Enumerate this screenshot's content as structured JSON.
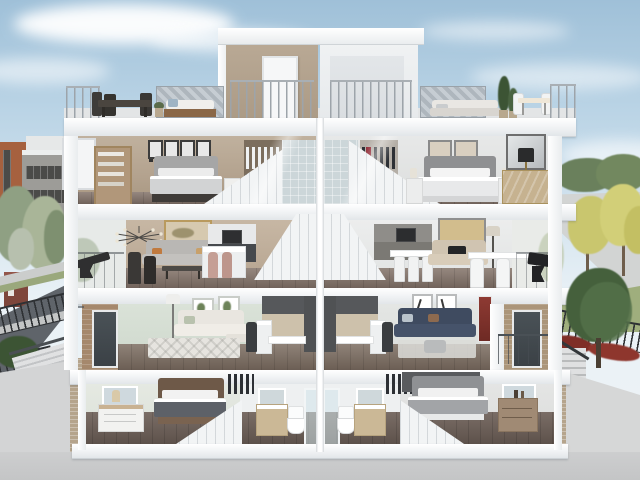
{
  "scene": {
    "kind": "3d-architectural-cutaway-render",
    "subject": "Cross-section (dollhouse) view of a pair of mirrored four-storey townhomes with rooftop terraces",
    "time_of_day": "day",
    "setting": "suburban street with landscaped boulevard"
  },
  "palette": {
    "sky_top": "#9fc0d8",
    "sky_horizon": "#eef3f6",
    "cloud": "#ffffff",
    "slab_white": "#f3f4f6",
    "cut_wall_white": "#fbfcfd",
    "wall_taupe": "#b3a28e",
    "wall_beige": "#bfae99",
    "wall_mint": "#d3dcd1",
    "wall_pale_gray": "#e2e4e3",
    "tile_blue_gray": "#ccd6d9",
    "terrace_deck": "#e3e5e6",
    "floor_wood": "#84746a",
    "floor_wood_dark": "#6b5d55",
    "kitchen_charcoal": "#46494d",
    "kitchen_greige": "#8f8d89",
    "cabinet_oak": "#cdc1ab",
    "sofa_gray": "#b9b7b4",
    "sofa_navy": "#3f4b60",
    "sofa_cream": "#e9e6e0",
    "sofa_beige": "#d0c4b1",
    "bed_duvet_charcoal": "#5d6168",
    "closet_accent_red": "#8e2430",
    "stool_blush": "#c59f95",
    "brick": "#a5886c",
    "privacy_screen": "#b9c1c7",
    "metal_railing": "#9fa6ab",
    "fence_black": "#2e3134",
    "asphalt": "#60646a",
    "sidewalk": "#c7c9c9",
    "concrete": "#d2d3d4",
    "grass": "#a3b07f",
    "tree_green": "#45603c",
    "tree_sage": "#93a383",
    "tree_yellow": "#c9c66e",
    "shrub_red": "#7f2e27"
  },
  "building": {
    "type": "two mirrored units around a central party wall, section cut facing the street",
    "floors": [
      {
        "name": "rooftop terrace",
        "left_unit": [
          "stair bulkhead with white door",
          "metal guard railing",
          "grey privacy screen",
          "dark outdoor dining set",
          "upholstered daybed",
          "planter"
        ],
        "right_unit": [
          "open stair bulkhead",
          "metal guard railing",
          "grey privacy screen",
          "cream outdoor sofa",
          "two potted evergreens",
          "bistro table with chairs"
        ]
      },
      {
        "name": "third floor bedrooms",
        "left_unit": [
          "open casement window",
          "oak bookcase",
          "four framed prints",
          "grey upholstered bed with sconces",
          "walk-in closet with white shirts and dark suits",
          "staircase",
          "tiled ensuite"
        ],
        "right_unit": [
          "tiled ensuite",
          "walk-in closet with red and dark garments",
          "staircase",
          "bed with white duvet and nightstand lamps",
          "pair of framed landscapes",
          "large framed artwork",
          "wood credenza with black table lamp"
        ]
      },
      {
        "name": "second floor living",
        "left_unit": [
          "balcony with black lounge chair",
          "sputnik chandelier",
          "framed abstract art",
          "grey sofa",
          "dark coffee table",
          "two dark dining chairs",
          "white and charcoal kitchen with microwave",
          "island with two blush stools",
          "staircase"
        ],
        "right_unit": [
          "staircase",
          "greige kitchen with microwave",
          "white table with stools",
          "beige sofa with black throw",
          "framed golden-field artwork",
          "floor lamp",
          "white desk with two chairs",
          "balcony with black butterfly chair"
        ]
      },
      {
        "name": "ground floor",
        "left_unit": [
          "brick facade with glazed door and glass balcony rail",
          "arc floor lamp",
          "botanical prints",
          "cream sectional sofa",
          "patterned rug",
          "charcoal and oak kitchen with white peninsula",
          "dark bar stool"
        ],
        "right_unit": [
          "charcoal and oak kitchen with white peninsula",
          "dark bar stool",
          "two framed figure sketches",
          "navy sectional sofa",
          "grey ottoman",
          "rug",
          "red artwork at the cut edge",
          "brick facade with glazed door and dark balcony railing"
        ]
      },
      {
        "name": "basement",
        "left_unit": [
          "egress window",
          "white nightstand with table lamp",
          "wood bed with charcoal duvet",
          "open clothes rack",
          "staircase",
          "bathroom with mirror, vanity, toilet and glass shower"
        ],
        "right_unit": [
          "bathroom with glass shower, toilet, vanity and mirror",
          "open clothes rack",
          "charcoal accent wall",
          "grey upholstered bed",
          "staircase",
          "wood dresser with decor",
          "egress window"
        ]
      }
    ]
  },
  "surroundings": {
    "left": [
      "orange-brick and grey townhouses",
      "white low-rise with roof rail",
      "street trees",
      "entry monument",
      "sidewalk",
      "asphalt road",
      "black metal fence",
      "hedge",
      "concrete retaining wall with steps",
      "brick pier at the cut"
    ],
    "right": [
      "distant tree line",
      "boulevard road",
      "yellow autumn trees",
      "lawn",
      "large green tree",
      "black metal fence with red shrubs",
      "garden steps with handrail",
      "concrete retaining wall",
      "brick pier at the cut"
    ],
    "foreground": "excavated grey ground plane along the section cut"
  }
}
